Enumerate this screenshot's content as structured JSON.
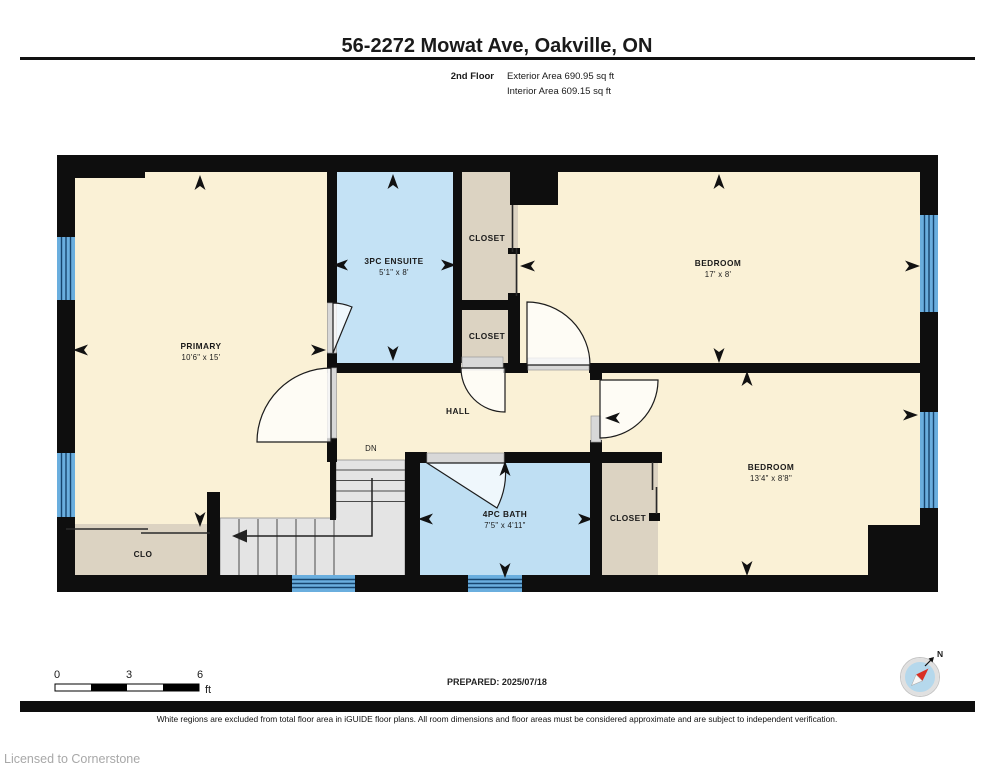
{
  "header": {
    "title": "56-2272 Mowat Ave, Oakville, ON",
    "floor_label": "2nd Floor",
    "exterior_area": "Exterior Area 690.95 sq ft",
    "interior_area": "Interior Area 609.15 sq ft"
  },
  "plan": {
    "rooms": [
      {
        "name": "PRIMARY",
        "dims": "10'6\" x 15'"
      },
      {
        "name": "3PC ENSUITE",
        "dims": "5'1\" x 8'"
      },
      {
        "name": "CLOSET"
      },
      {
        "name": "BEDROOM",
        "dims": "17' x 8'"
      },
      {
        "name": "CLOSET"
      },
      {
        "name": "HALL"
      },
      {
        "name": "4PC BATH",
        "dims": "7'5\" x 4'11\""
      },
      {
        "name": "CLOSET"
      },
      {
        "name": "BEDROOM",
        "dims": "13'4\" x 8'8\""
      },
      {
        "name": "CLO"
      },
      {
        "name": "DN"
      }
    ]
  },
  "scale_bar": {
    "ticks": [
      "0",
      "3",
      "6"
    ],
    "unit": "ft"
  },
  "compass": {
    "north_label": "N"
  },
  "footer": {
    "prepared": "PREPARED: 2025/07/18",
    "disclaimer": "White regions are excluded from total floor area in iGUIDE floor plans. All room dimensions and floor areas must be considered approximate and are subject to independent verification.",
    "license": "Licensed to Cornerstone"
  },
  "colors": {
    "wall": "#0e0e0e",
    "room_cream": "#faf1d6",
    "room_blue": "#c4e2f5",
    "closet_beige": "#dcd3c2",
    "stairs_gray": "#e4e4e4",
    "window_blue": "#6aaede",
    "needle_red": "#d93025"
  }
}
